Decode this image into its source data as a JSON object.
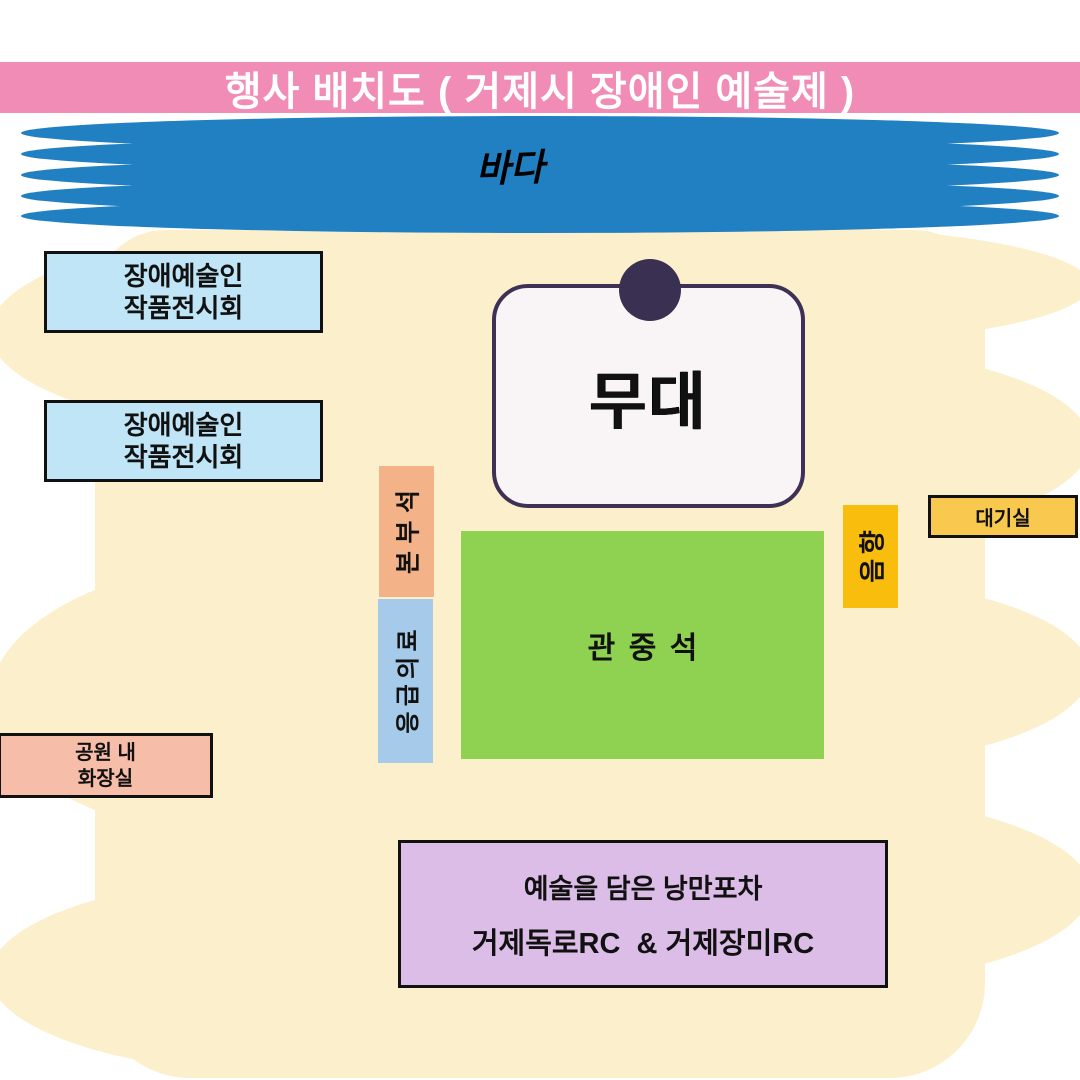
{
  "title": "행사 배치도 ( 거제시 장애인 예술제 )",
  "sea": {
    "label": "바다"
  },
  "zones": {
    "exhibitions": [
      {
        "line1": "장애예술인",
        "line2": "작품전시회"
      },
      {
        "line1": "장애예술인",
        "line2": "작품전시회"
      }
    ],
    "stage": {
      "label": "무대"
    },
    "hq": {
      "label": "본부석"
    },
    "first_aid": {
      "label": "응급의료"
    },
    "audience": {
      "label": "관중석"
    },
    "sound": {
      "label": "음향"
    },
    "waiting_room": {
      "label": "대기실"
    },
    "park_restroom": {
      "line1": "공원 내",
      "line2": "화장실"
    },
    "pocha": {
      "line1": "예술을 담은 낭만포차",
      "line2": "거제독로RC  & 거제장미RC"
    }
  },
  "colors": {
    "banner_pink": "#F08CB5",
    "sea_blue": "#2080C2",
    "park_cream": "#FCF0CC",
    "exhibition_blue": "#BFE5F6",
    "stage_fill": "#F9F4F5",
    "stage_border": "#3E3155",
    "stage_dot": "#3A3052",
    "hq_orange": "#F3B287",
    "first_aid_blue": "#A6CAE9",
    "audience_green": "#8FD150",
    "sound_yellow": "#F8BD0D",
    "waiting_yellow": "#F9C94F",
    "restroom_pink": "#F6BDA9",
    "pocha_purple": "#DCBDE8"
  }
}
